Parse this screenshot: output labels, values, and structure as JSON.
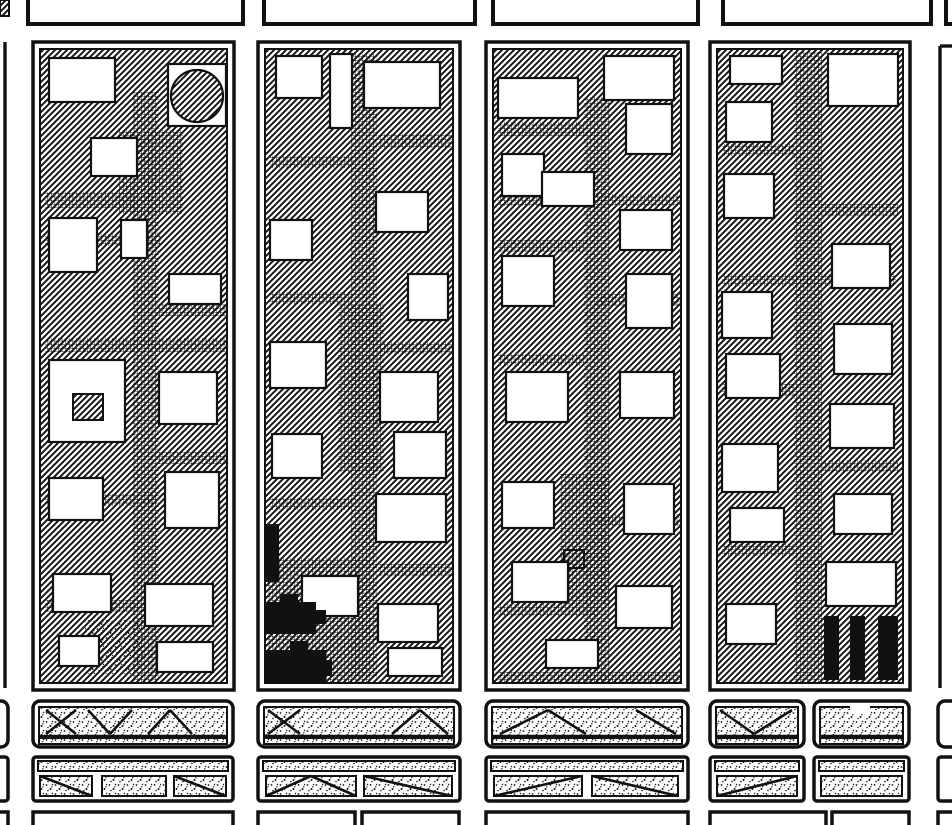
{
  "canvas": {
    "width": 952,
    "height": 825,
    "paper_color": "#ffffff",
    "ink_color": "#111111"
  },
  "map": {
    "kind": "urban figure-ground block map",
    "texture_legend": {
      "hatch": "building mass (diagonal hatch)",
      "cross": "paved court / mid-block alley (fine grid)",
      "white": "open courtyard",
      "black": "solid special building",
      "stipple": "yard / embankment (dotted)"
    }
  },
  "north_row": {
    "name": "north-block-outlines",
    "shapes": [
      [
        "h",
        0,
        0,
        9,
        16
      ],
      [
        "r",
        28,
        -18,
        215,
        42,
        0,
        4
      ],
      [
        "r",
        264,
        -18,
        211,
        42,
        0,
        4
      ],
      [
        "r",
        493,
        -18,
        205,
        42,
        0,
        4
      ],
      [
        "r",
        723,
        -18,
        208,
        42,
        0,
        4
      ],
      [
        "r",
        946,
        -18,
        60,
        42,
        0,
        4
      ]
    ]
  },
  "street_edges": {
    "name": "neighbor-block-edges",
    "shapes": [
      [
        "l",
        5,
        42,
        5,
        688
      ],
      [
        "l",
        940,
        46,
        940,
        688
      ],
      [
        "l",
        940,
        46,
        952,
        46
      ]
    ]
  },
  "blocks": [
    {
      "name": "city-block-1",
      "x": 33,
      "y": 42,
      "w": 201,
      "h": 648,
      "shapes": [
        [
          "hs",
          7,
          7,
          187,
          634
        ],
        [
          "x",
          100,
          50,
          26,
          592
        ],
        [
          "x",
          86,
          88,
          64,
          84
        ],
        [
          "x",
          12,
          150,
          90,
          16
        ],
        [
          "x",
          12,
          192,
          116,
          12
        ],
        [
          "x",
          12,
          296,
          182,
          14
        ],
        [
          "x",
          126,
          262,
          68,
          12
        ],
        [
          "x",
          12,
          452,
          112,
          12
        ],
        [
          "x",
          126,
          410,
          68,
          12
        ],
        [
          "x",
          12,
          558,
          100,
          12
        ],
        [
          "w",
          16,
          16,
          66,
          44
        ],
        [
          "w",
          58,
          96,
          46,
          38
        ],
        [
          "w",
          135,
          22,
          58,
          62
        ],
        [
          "c",
          164,
          54,
          26
        ],
        [
          "w",
          16,
          176,
          48,
          54
        ],
        [
          "w",
          88,
          178,
          26,
          38
        ],
        [
          "w",
          136,
          232,
          52,
          30
        ],
        [
          "w",
          16,
          318,
          76,
          82
        ],
        [
          "h",
          40,
          352,
          30,
          26
        ],
        [
          "w",
          126,
          330,
          58,
          52
        ],
        [
          "w",
          16,
          436,
          54,
          42
        ],
        [
          "w",
          132,
          430,
          54,
          56
        ],
        [
          "w",
          20,
          532,
          58,
          38
        ],
        [
          "w",
          112,
          542,
          68,
          42
        ],
        [
          "s",
          52,
          578,
          58,
          54
        ],
        [
          "w",
          26,
          594,
          40,
          30
        ],
        [
          "w",
          124,
          600,
          56,
          30
        ]
      ]
    },
    {
      "name": "city-block-2",
      "x": 258,
      "y": 42,
      "w": 202,
      "h": 648,
      "shapes": [
        [
          "hs",
          7,
          7,
          188,
          634
        ],
        [
          "x",
          93,
          12,
          26,
          624
        ],
        [
          "x",
          80,
          262,
          46,
          168
        ],
        [
          "x",
          10,
          516,
          102,
          126
        ],
        [
          "x",
          120,
          92,
          74,
          14
        ],
        [
          "x",
          12,
          114,
          84,
          12
        ],
        [
          "x",
          12,
          250,
          82,
          12
        ],
        [
          "x",
          120,
          300,
          74,
          12
        ],
        [
          "x",
          12,
          456,
          82,
          12
        ],
        [
          "x",
          120,
          522,
          74,
          12
        ],
        [
          "w",
          18,
          14,
          46,
          42
        ],
        [
          "w",
          72,
          12,
          22,
          74
        ],
        [
          "w",
          106,
          20,
          76,
          46
        ],
        [
          "w",
          12,
          178,
          42,
          40
        ],
        [
          "w",
          118,
          150,
          52,
          40
        ],
        [
          "w",
          150,
          232,
          40,
          46
        ],
        [
          "w",
          12,
          300,
          56,
          46
        ],
        [
          "w",
          122,
          330,
          58,
          50
        ],
        [
          "w",
          136,
          390,
          52,
          46
        ],
        [
          "w",
          14,
          392,
          50,
          44
        ],
        [
          "w",
          118,
          452,
          70,
          48
        ],
        [
          "w",
          44,
          534,
          56,
          40
        ],
        [
          "w",
          120,
          562,
          60,
          38
        ],
        [
          "w",
          130,
          606,
          54,
          28
        ],
        [
          "b",
          8,
          482,
          13,
          58
        ],
        [
          "b",
          8,
          560,
          50,
          32
        ],
        [
          "b",
          56,
          568,
          12,
          14
        ],
        [
          "b",
          22,
          552,
          18,
          8
        ],
        [
          "b",
          8,
          608,
          60,
          34
        ],
        [
          "b",
          32,
          599,
          18,
          10
        ],
        [
          "b",
          66,
          618,
          8,
          16
        ]
      ]
    },
    {
      "name": "city-block-3",
      "x": 486,
      "y": 42,
      "w": 202,
      "h": 648,
      "shapes": [
        [
          "hs",
          7,
          7,
          188,
          634
        ],
        [
          "x",
          98,
          55,
          26,
          587
        ],
        [
          "x",
          74,
          432,
          50,
          130
        ],
        [
          "x",
          12,
          80,
          86,
          14
        ],
        [
          "x",
          12,
          152,
          182,
          12
        ],
        [
          "x",
          12,
          198,
          86,
          12
        ],
        [
          "x",
          110,
          252,
          84,
          12
        ],
        [
          "x",
          12,
          312,
          86,
          12
        ],
        [
          "x",
          110,
          472,
          84,
          12
        ],
        [
          "x",
          12,
          562,
          100,
          12
        ],
        [
          "x",
          12,
          630,
          182,
          11
        ],
        [
          "w",
          12,
          36,
          80,
          40
        ],
        [
          "w",
          118,
          14,
          70,
          44
        ],
        [
          "w",
          16,
          112,
          42,
          42
        ],
        [
          "w",
          56,
          130,
          52,
          34
        ],
        [
          "w",
          140,
          62,
          46,
          50
        ],
        [
          "w",
          134,
          168,
          52,
          40
        ],
        [
          "w",
          16,
          214,
          52,
          50
        ],
        [
          "w",
          140,
          232,
          46,
          54
        ],
        [
          "w",
          20,
          330,
          62,
          50
        ],
        [
          "w",
          134,
          330,
          54,
          46
        ],
        [
          "h",
          78,
          508,
          20,
          18
        ],
        [
          "w",
          16,
          440,
          52,
          46
        ],
        [
          "w",
          138,
          442,
          50,
          50
        ],
        [
          "w",
          26,
          520,
          56,
          40
        ],
        [
          "w",
          130,
          544,
          56,
          42
        ],
        [
          "w",
          60,
          598,
          52,
          28
        ]
      ]
    },
    {
      "name": "city-block-4",
      "x": 710,
      "y": 42,
      "w": 200,
      "h": 648,
      "shapes": [
        [
          "hs",
          7,
          7,
          186,
          634
        ],
        [
          "x",
          84,
          10,
          28,
          632
        ],
        [
          "x",
          12,
          102,
          72,
          12
        ],
        [
          "x",
          112,
          162,
          76,
          12
        ],
        [
          "x",
          12,
          232,
          174,
          12
        ],
        [
          "x",
          12,
          342,
          72,
          12
        ],
        [
          "x",
          112,
          418,
          76,
          12
        ],
        [
          "x",
          12,
          502,
          72,
          12
        ],
        [
          "w",
          20,
          14,
          52,
          28
        ],
        [
          "w",
          118,
          12,
          70,
          52
        ],
        [
          "w",
          16,
          60,
          46,
          40
        ],
        [
          "w",
          14,
          132,
          50,
          44
        ],
        [
          "w",
          122,
          202,
          58,
          44
        ],
        [
          "w",
          12,
          250,
          50,
          46
        ],
        [
          "w",
          124,
          282,
          58,
          50
        ],
        [
          "w",
          16,
          312,
          54,
          44
        ],
        [
          "w",
          120,
          362,
          64,
          44
        ],
        [
          "w",
          12,
          402,
          56,
          48
        ],
        [
          "w",
          124,
          452,
          58,
          40
        ],
        [
          "w",
          20,
          466,
          54,
          34
        ],
        [
          "w",
          116,
          520,
          70,
          44
        ],
        [
          "w",
          16,
          562,
          50,
          40
        ],
        [
          "b",
          114,
          574,
          15,
          64
        ],
        [
          "b",
          140,
          574,
          15,
          64
        ],
        [
          "b",
          168,
          574,
          20,
          64
        ]
      ]
    }
  ],
  "south_rows": {
    "name": "south-yard-bars",
    "shapes": [
      [
        "r",
        33,
        701,
        200,
        46,
        7,
        3.5
      ],
      [
        "sr",
        39,
        707,
        188,
        29
      ],
      [
        "l",
        39,
        736,
        227,
        736
      ],
      [
        "sr",
        39,
        738,
        188,
        6
      ],
      [
        "l",
        46,
        710,
        76,
        734
      ],
      [
        "l",
        46,
        734,
        76,
        710
      ],
      [
        "l",
        88,
        710,
        110,
        734
      ],
      [
        "l",
        110,
        734,
        132,
        710
      ],
      [
        "l",
        148,
        734,
        170,
        710
      ],
      [
        "l",
        170,
        710,
        192,
        734
      ],
      [
        "r",
        258,
        701,
        202,
        46,
        7,
        3.5
      ],
      [
        "sr",
        264,
        707,
        190,
        29
      ],
      [
        "l",
        264,
        736,
        454,
        736
      ],
      [
        "sr",
        264,
        738,
        190,
        6
      ],
      [
        "l",
        268,
        710,
        300,
        734
      ],
      [
        "l",
        268,
        734,
        300,
        710
      ],
      [
        "l",
        392,
        734,
        420,
        710
      ],
      [
        "l",
        420,
        710,
        448,
        734
      ],
      [
        "r",
        486,
        701,
        202,
        46,
        7,
        3.5
      ],
      [
        "sr",
        492,
        707,
        190,
        29
      ],
      [
        "l",
        492,
        736,
        682,
        736
      ],
      [
        "sr",
        492,
        738,
        190,
        6
      ],
      [
        "l",
        500,
        734,
        548,
        710
      ],
      [
        "l",
        548,
        710,
        586,
        734
      ],
      [
        "l",
        636,
        710,
        676,
        734
      ],
      [
        "r",
        710,
        701,
        94,
        46,
        7,
        3.5
      ],
      [
        "sr",
        716,
        707,
        82,
        29
      ],
      [
        "l",
        716,
        736,
        798,
        736
      ],
      [
        "sr",
        716,
        738,
        82,
        6
      ],
      [
        "l",
        720,
        710,
        754,
        734
      ],
      [
        "l",
        754,
        734,
        792,
        710
      ],
      [
        "r",
        814,
        701,
        95,
        46,
        7,
        3.5
      ],
      [
        "sr",
        820,
        707,
        83,
        29
      ],
      [
        "l",
        820,
        736,
        903,
        736
      ],
      [
        "sr",
        820,
        738,
        83,
        6
      ],
      [
        "wr",
        850,
        705,
        20,
        9
      ],
      [
        "r",
        -40,
        701,
        48,
        46,
        7,
        3.5
      ],
      [
        "r",
        938,
        701,
        64,
        46,
        7,
        3.5
      ],
      [
        "r",
        33,
        757,
        200,
        44,
        3,
        3.5
      ],
      [
        "sr",
        38,
        761,
        190,
        10
      ],
      [
        "sr",
        40,
        776,
        52,
        20
      ],
      [
        "l",
        40,
        776,
        92,
        796
      ],
      [
        "sr",
        102,
        776,
        64,
        20
      ],
      [
        "sr",
        174,
        776,
        52,
        20
      ],
      [
        "l",
        174,
        776,
        226,
        796
      ],
      [
        "r",
        258,
        757,
        202,
        44,
        3,
        3.5
      ],
      [
        "sr",
        263,
        761,
        192,
        10
      ],
      [
        "sr",
        266,
        776,
        90,
        20
      ],
      [
        "l",
        266,
        796,
        311,
        776
      ],
      [
        "l",
        311,
        776,
        356,
        796
      ],
      [
        "sr",
        364,
        776,
        88,
        20
      ],
      [
        "l",
        364,
        776,
        452,
        796
      ],
      [
        "r",
        486,
        757,
        202,
        44,
        3,
        3.5
      ],
      [
        "sr",
        491,
        761,
        192,
        10
      ],
      [
        "sr",
        494,
        776,
        88,
        20
      ],
      [
        "l",
        494,
        796,
        582,
        776
      ],
      [
        "sr",
        592,
        776,
        86,
        20
      ],
      [
        "l",
        592,
        776,
        678,
        796
      ],
      [
        "r",
        710,
        757,
        94,
        44,
        3,
        3.5
      ],
      [
        "sr",
        715,
        761,
        84,
        10
      ],
      [
        "sr",
        717,
        776,
        80,
        20
      ],
      [
        "l",
        717,
        796,
        797,
        776
      ],
      [
        "r",
        814,
        757,
        95,
        44,
        3,
        3.5
      ],
      [
        "sr",
        819,
        761,
        85,
        10
      ],
      [
        "sr",
        821,
        776,
        81,
        20
      ],
      [
        "r",
        -40,
        757,
        48,
        44,
        3,
        3.5
      ],
      [
        "r",
        938,
        757,
        64,
        44,
        3,
        3.5
      ],
      [
        "r",
        33,
        812,
        200,
        40,
        0,
        3.5
      ],
      [
        "r",
        258,
        812,
        97,
        40,
        0,
        3.5
      ],
      [
        "r",
        362,
        812,
        97,
        40,
        0,
        3.5
      ],
      [
        "r",
        486,
        812,
        202,
        40,
        0,
        3.5
      ],
      [
        "r",
        710,
        812,
        116,
        40,
        0,
        3.5
      ],
      [
        "r",
        832,
        812,
        77,
        40,
        0,
        3.5
      ],
      [
        "r",
        -40,
        812,
        48,
        40,
        0,
        3.5
      ],
      [
        "r",
        938,
        812,
        64,
        40,
        0,
        3.5
      ]
    ]
  }
}
